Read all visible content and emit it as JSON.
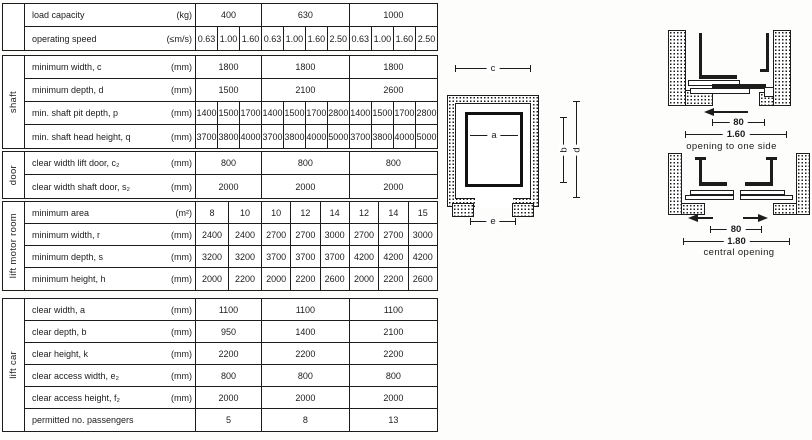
{
  "table": {
    "sections": [
      {
        "id": "capacity",
        "side_label": "",
        "rows": [
          {
            "label": "load capacity",
            "unit": "(kg)",
            "values": [
              [
                "400"
              ],
              [
                "630"
              ],
              [
                "1000"
              ]
            ]
          },
          {
            "label": "operating speed",
            "unit": "(≤m/s)",
            "values": [
              [
                "0.63",
                "1.00",
                "1.60"
              ],
              [
                "0.63",
                "1.00",
                "1.60",
                "2.50"
              ],
              [
                "0.63",
                "1.00",
                "1.60",
                "2.50"
              ]
            ]
          }
        ]
      },
      {
        "id": "shaft",
        "side_label": "shaft",
        "rows": [
          {
            "label": "minimum width, c",
            "unit": "(mm)",
            "values": [
              [
                "1800"
              ],
              [
                "1800"
              ],
              [
                "1800"
              ]
            ]
          },
          {
            "label": "minimum depth, d",
            "unit": "(mm)",
            "values": [
              [
                "1500"
              ],
              [
                "2100"
              ],
              [
                "2600"
              ]
            ]
          },
          {
            "label": "min. shaft pit depth, p",
            "unit": "(mm)",
            "values": [
              [
                "1400",
                "1500",
                "1700"
              ],
              [
                "1400",
                "1500",
                "1700",
                "2800"
              ],
              [
                "1400",
                "1500",
                "1700",
                "2800"
              ]
            ]
          },
          {
            "label": "min. shaft head height, q",
            "unit": "(mm)",
            "values": [
              [
                "3700",
                "3800",
                "4000"
              ],
              [
                "3700",
                "3800",
                "4000",
                "5000"
              ],
              [
                "3700",
                "3800",
                "4000",
                "5000"
              ]
            ]
          }
        ]
      },
      {
        "id": "door",
        "side_label": "door",
        "rows": [
          {
            "label": "clear width lift door, c₂",
            "unit": "(mm)",
            "values": [
              [
                "800"
              ],
              [
                "800"
              ],
              [
                "800"
              ]
            ]
          },
          {
            "label": "clear width shaft door, s₂",
            "unit": "(mm)",
            "values": [
              [
                "2000"
              ],
              [
                "2000"
              ],
              [
                "2000"
              ]
            ]
          }
        ]
      },
      {
        "id": "motor-room",
        "side_label": "lift motor room",
        "rows": [
          {
            "label": "minimum area",
            "unit": "(m²)",
            "values": [
              [
                "8",
                "10"
              ],
              [
                "10",
                "12",
                "14"
              ],
              [
                "12",
                "14",
                "15"
              ]
            ]
          },
          {
            "label": "minimum width, r",
            "unit": "(mm)",
            "values": [
              [
                "2400",
                "2400"
              ],
              [
                "2700",
                "2700",
                "3000"
              ],
              [
                "2700",
                "2700",
                "3000"
              ]
            ]
          },
          {
            "label": "minimum depth, s",
            "unit": "(mm)",
            "values": [
              [
                "3200",
                "3200"
              ],
              [
                "3700",
                "3700",
                "3700"
              ],
              [
                "4200",
                "4200",
                "4200"
              ]
            ]
          },
          {
            "label": "minimum height, h",
            "unit": "(mm)",
            "values": [
              [
                "2000",
                "2200"
              ],
              [
                "2000",
                "2200",
                "2600"
              ],
              [
                "2000",
                "2200",
                "2600"
              ]
            ]
          }
        ]
      },
      {
        "id": "lift-car",
        "side_label": "lift car",
        "rows": [
          {
            "label": "clear width, a",
            "unit": "(mm)",
            "values": [
              [
                "1100"
              ],
              [
                "1100"
              ],
              [
                "1100"
              ]
            ]
          },
          {
            "label": "clear depth, b",
            "unit": "(mm)",
            "values": [
              [
                "950"
              ],
              [
                "1400"
              ],
              [
                "2100"
              ]
            ]
          },
          {
            "label": "clear height, k",
            "unit": "(mm)",
            "values": [
              [
                "2200"
              ],
              [
                "2200"
              ],
              [
                "2200"
              ]
            ]
          },
          {
            "label": "clear access width, e₂",
            "unit": "(mm)",
            "values": [
              [
                "800"
              ],
              [
                "800"
              ],
              [
                "800"
              ]
            ]
          },
          {
            "label": "clear access height, f₂",
            "unit": "(mm)",
            "values": [
              [
                "2000"
              ],
              [
                "2000"
              ],
              [
                "2000"
              ]
            ]
          },
          {
            "label": "permitted no. passengers",
            "unit": "",
            "values": [
              [
                "5"
              ],
              [
                "8"
              ],
              [
                "13"
              ]
            ]
          }
        ]
      }
    ]
  },
  "plan": {
    "labels": {
      "a": "a",
      "b": "b",
      "c": "c",
      "d": "d",
      "e": "e"
    }
  },
  "door_diagrams": [
    {
      "clear_opening": "80",
      "overall": "1.60",
      "caption": "opening to one side"
    },
    {
      "clear_opening": "80",
      "overall": "1.80",
      "caption": "central opening"
    }
  ]
}
